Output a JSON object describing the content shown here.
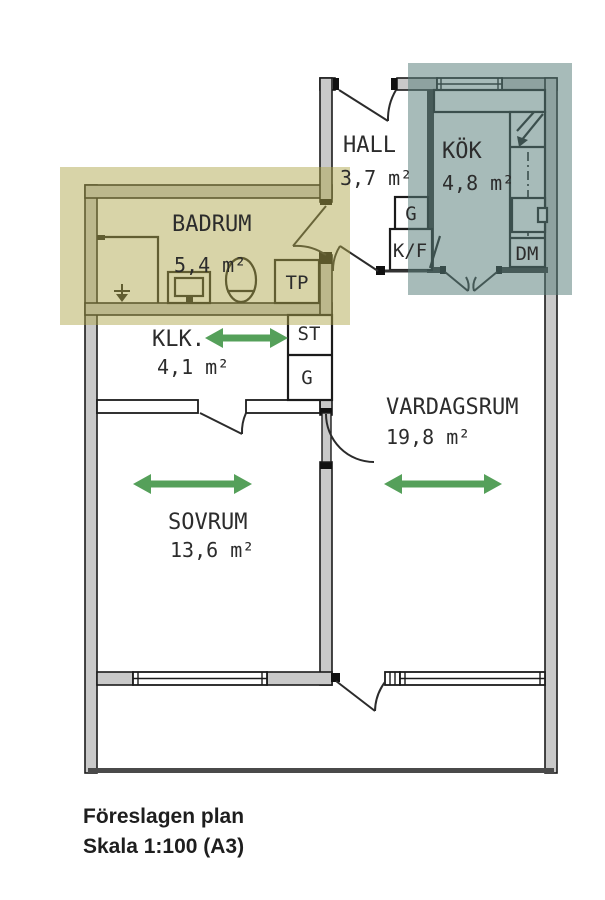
{
  "floorplan": {
    "rooms": [
      {
        "name": "HALL",
        "area": "3,7 m²"
      },
      {
        "name": "KÖK",
        "area": "4,8 m²"
      },
      {
        "name": "BADRUM",
        "area": "5,4 m²"
      },
      {
        "name": "KLK.",
        "area": "4,1 m²"
      },
      {
        "name": "VARDAGSRUM",
        "area": "19,8 m²"
      },
      {
        "name": "SOVRUM",
        "area": "13,6 m²"
      }
    ],
    "labels": {
      "g_hall": "G",
      "kf": "K/F",
      "dm": "DM",
      "tp": "TP",
      "st": "ST",
      "g_closet": "G"
    },
    "highlights": {
      "bathroom": "rgba(173,165,74,0.48)",
      "bathroom_hex": "#dbd7a4",
      "kitchen": "rgba(88,126,123,0.53)",
      "kitchen_hex": "#a9bebc"
    },
    "arrow_color": "#55a05a",
    "wall_color": "#c9c9c9",
    "line_color": "#1b1b1b"
  },
  "caption": {
    "line1": "Föreslagen plan",
    "line2": "Skala 1:100 (A3)"
  }
}
